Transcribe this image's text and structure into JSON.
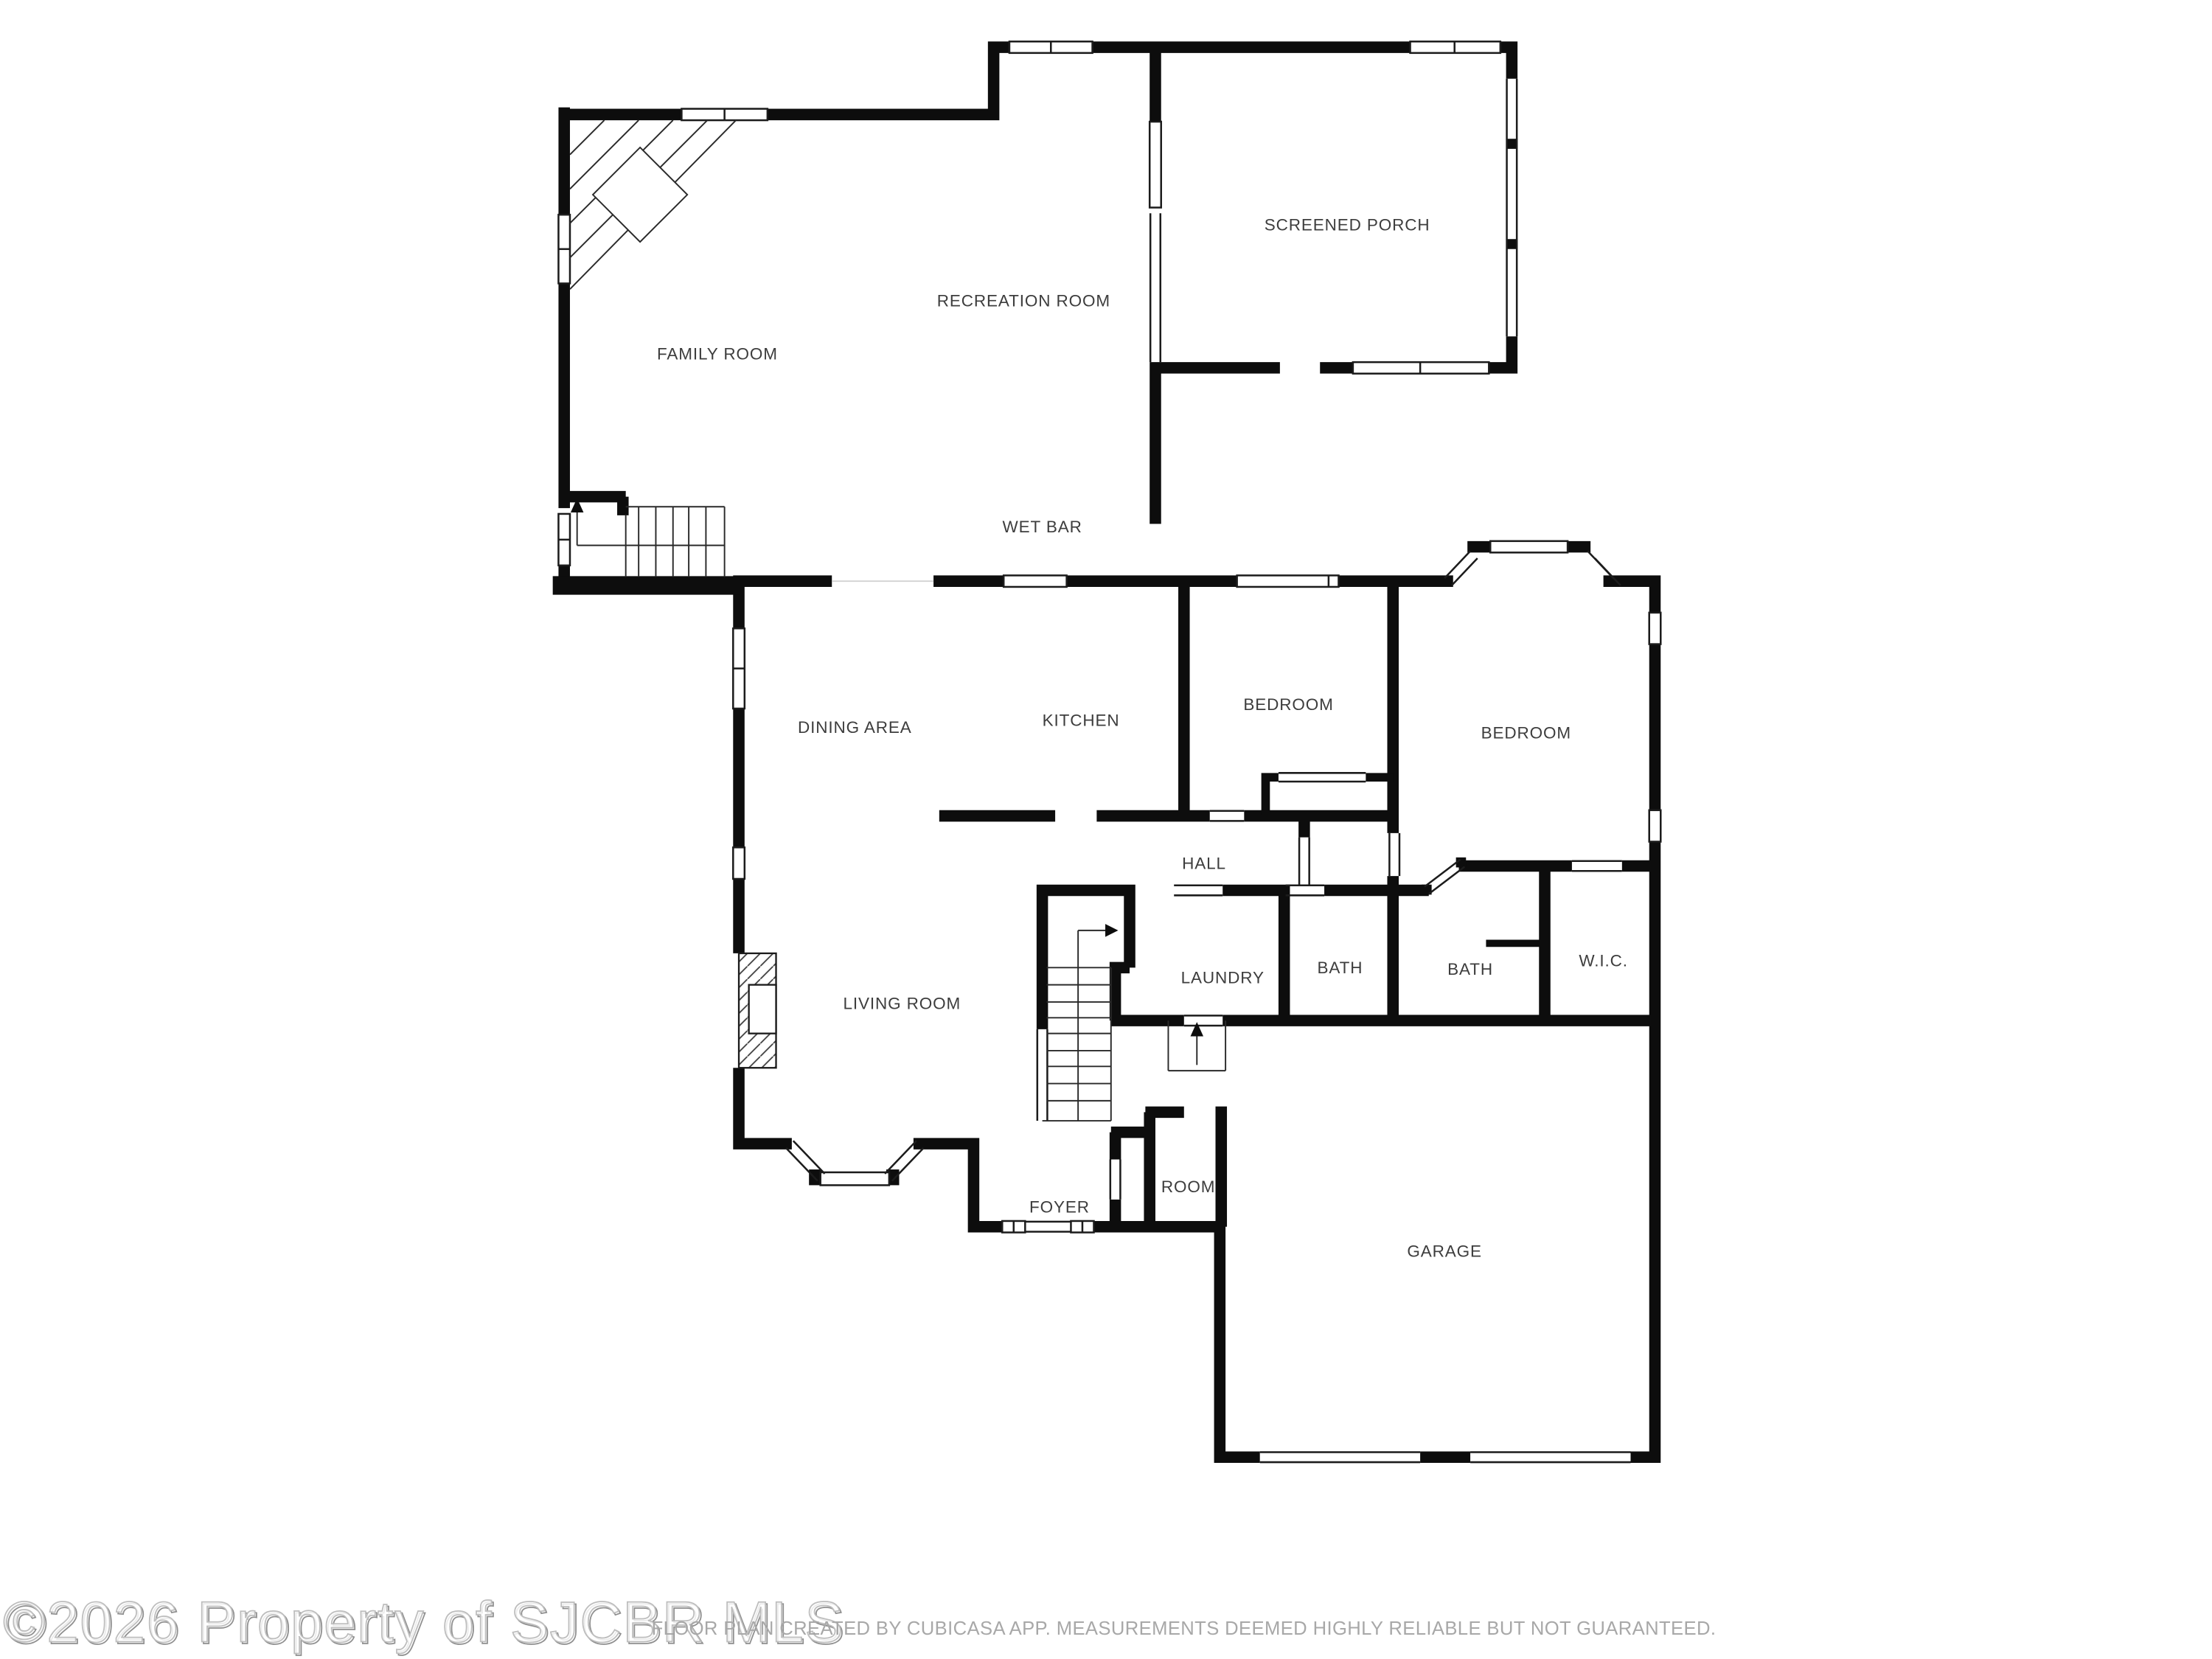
{
  "meta": {
    "background_color": "#ffffff",
    "wall_color": "#0d0d0d",
    "label_color": "#3d3d3d",
    "watermark_color": "#b5b5b5",
    "disclaimer_color": "#a8a8a8"
  },
  "rooms": [
    {
      "id": "screened-porch",
      "label": "SCREENED PORCH"
    },
    {
      "id": "recreation-room",
      "label": "RECREATION ROOM"
    },
    {
      "id": "family-room",
      "label": "FAMILY ROOM"
    },
    {
      "id": "wet-bar",
      "label": "WET BAR"
    },
    {
      "id": "dining-area",
      "label": "DINING AREA"
    },
    {
      "id": "kitchen",
      "label": "KITCHEN"
    },
    {
      "id": "bedroom-1",
      "label": "BEDROOM"
    },
    {
      "id": "bedroom-2",
      "label": "BEDROOM"
    },
    {
      "id": "hall",
      "label": "HALL"
    },
    {
      "id": "laundry",
      "label": "LAUNDRY"
    },
    {
      "id": "bath-1",
      "label": "BATH"
    },
    {
      "id": "bath-2",
      "label": "BATH"
    },
    {
      "id": "wic",
      "label": "W.I.C."
    },
    {
      "id": "living-room",
      "label": "LIVING ROOM"
    },
    {
      "id": "foyer",
      "label": "FOYER"
    },
    {
      "id": "room",
      "label": "ROOM"
    },
    {
      "id": "garage",
      "label": "GARAGE"
    }
  ],
  "watermark": {
    "text": "©2026 Property of SJCBR MLS"
  },
  "disclaimer": {
    "text": "FLOOR PLAN CREATED BY CUBICASA APP. MEASUREMENTS DEEMED HIGHLY RELIABLE BUT NOT GUARANTEED."
  }
}
